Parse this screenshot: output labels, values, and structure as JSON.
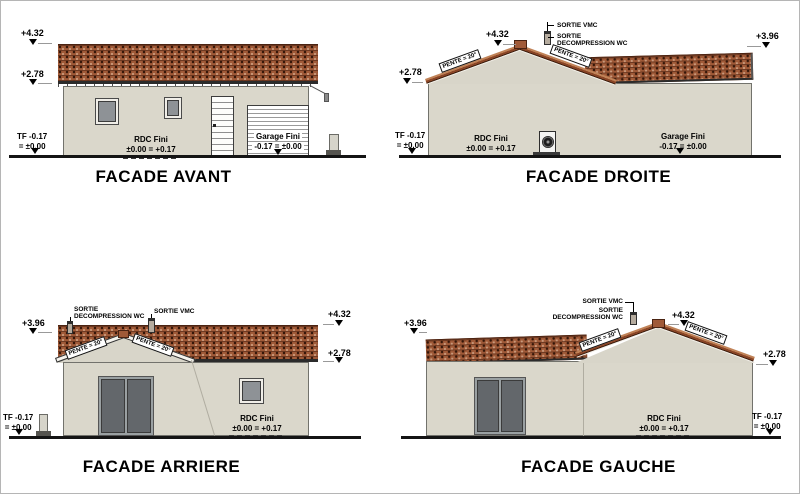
{
  "colors": {
    "roof_tile": "#a05a38",
    "roof_edge": "#4a2312",
    "wall": "#dad7cb",
    "glass": "#8e9296",
    "ground_line": "#141414"
  },
  "labels": {
    "lvl_432": "+4.32",
    "lvl_278": "+2.78",
    "lvl_396": "+3.96",
    "tf_line1": "TF -0.17",
    "tf_line2": "= ±0.00",
    "rdc_name": "RDC Fini",
    "rdc_value": "±0.00 = +0.17",
    "garage_name": "Garage Fini",
    "garage_value": "-0.17 = ±0.00",
    "sortie_vmc": "SORTIE VMC",
    "sortie_line1": "SORTIE",
    "sortie_line2": "DECOMPRESSION WC",
    "pente": "PENTE = 20°"
  },
  "titles": {
    "avant": "FACADE AVANT",
    "droite": "FACADE DROITE",
    "arriere": "FACADE ARRIERE",
    "gauche": "FACADE GAUCHE"
  }
}
